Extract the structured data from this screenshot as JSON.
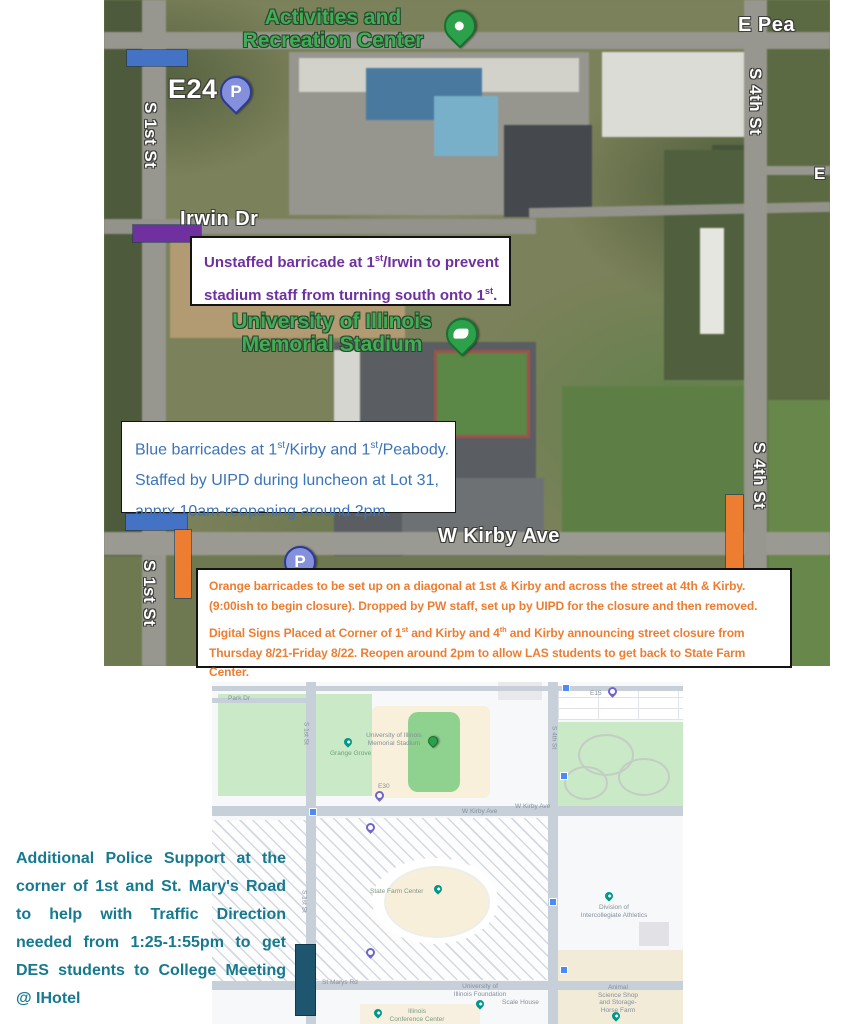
{
  "colors": {
    "barricade_blue": "#4472C4",
    "barricade_purple": "#7030A0",
    "barricade_orange": "#ED7D31",
    "barricade_dark_teal": "#1D566E",
    "note_purple_text": "#7030A0",
    "note_blue_text": "#3B74B9",
    "note_orange_text": "#ED7D31",
    "note_teal_text": "#17798F",
    "map_place_label_green": "#3FAF54"
  },
  "top_map": {
    "street_labels": {
      "e_peabody": "E Pea",
      "s_1st_upper": "S 1st St",
      "irwin_dr": "Irwin Dr",
      "s_4th_upper": "S 4th St",
      "e_partial": "E",
      "w_kirby": "W Kirby Ave",
      "s_1st_lower": "S 1st St",
      "s_4th_lower": "S 4th St"
    },
    "place_labels": {
      "arc_line1": "Activities and",
      "arc_line2": "Recreation Center",
      "stadium_line1": "University of Illinois",
      "stadium_line2": "Memorial Stadium",
      "lot_e24": "E24",
      "parking_glyph": "P"
    }
  },
  "notes": {
    "purple": {
      "l1a": "Unstaffed barricade at 1",
      "l1sup": "st",
      "l1b": "/Irwin to prevent",
      "l2a": "stadium staff from turning south onto 1",
      "l2sup": "st",
      "l2b": "."
    },
    "blue": {
      "l1a": "Blue barricades at 1",
      "s1": "st",
      "l1b": "/Kirby and 1",
      "s2": "st",
      "l1c": "/Peabody.",
      "l2": "Staffed by UIPD during luncheon at Lot 31,",
      "l3": "apprx 10am-reopening around 2pm."
    },
    "orange": {
      "p1": "Orange barricades to be set up on a diagonal at 1st & Kirby and across the street at 4th & Kirby. (9:00ish to begin closure). Dropped by PW staff, set up by UIPD for the closure and then removed.",
      "p2a": "Digital Signs Placed at Corner of 1",
      "p2s1": "st",
      "p2b": " and Kirby and 4",
      "p2s2": "th",
      "p2c": " and Kirby announcing street closure from Thursday 8/21-Friday 8/22.  Reopen around 2pm to allow LAS students to get back to State Farm Center."
    },
    "teal": "Additional Police Support at the corner of 1st and St. Mary's Road to help with Traffic Direction needed from 1:25-1:55pm to get DES students to College Meeting @ IHotel"
  },
  "bottom_map": {
    "labels": {
      "stadium_line1": "University of Illinois",
      "stadium_line2": "Memorial Stadium",
      "grange_grove": "Grange Grove",
      "lot_e30": "E30",
      "lot_e15": "E15",
      "park_dr": "Park Dr",
      "w_kirby_west": "W Kirby Ave",
      "w_kirby_east": "W Kirby Ave",
      "s_1st_upper": "S 1st St",
      "s_1st_lower": "S 1st St",
      "s_4th": "S 4th St",
      "state_farm_center": "State Farm Center",
      "st_marys_rd": "St Marys Rd",
      "uif_line1": "University of",
      "uif_line2": "Illinois Foundation",
      "scale_house": "Scale House",
      "icc_line1": "Illinois",
      "icc_line2": "Conference Center",
      "dia_line1": "Division of",
      "dia_line2": "Intercollegiate Athletics",
      "animal_line1": "Animal",
      "animal_line2": "Science Shop",
      "animal_line3": "and Storage-",
      "animal_line4": "Horse Farm"
    }
  }
}
